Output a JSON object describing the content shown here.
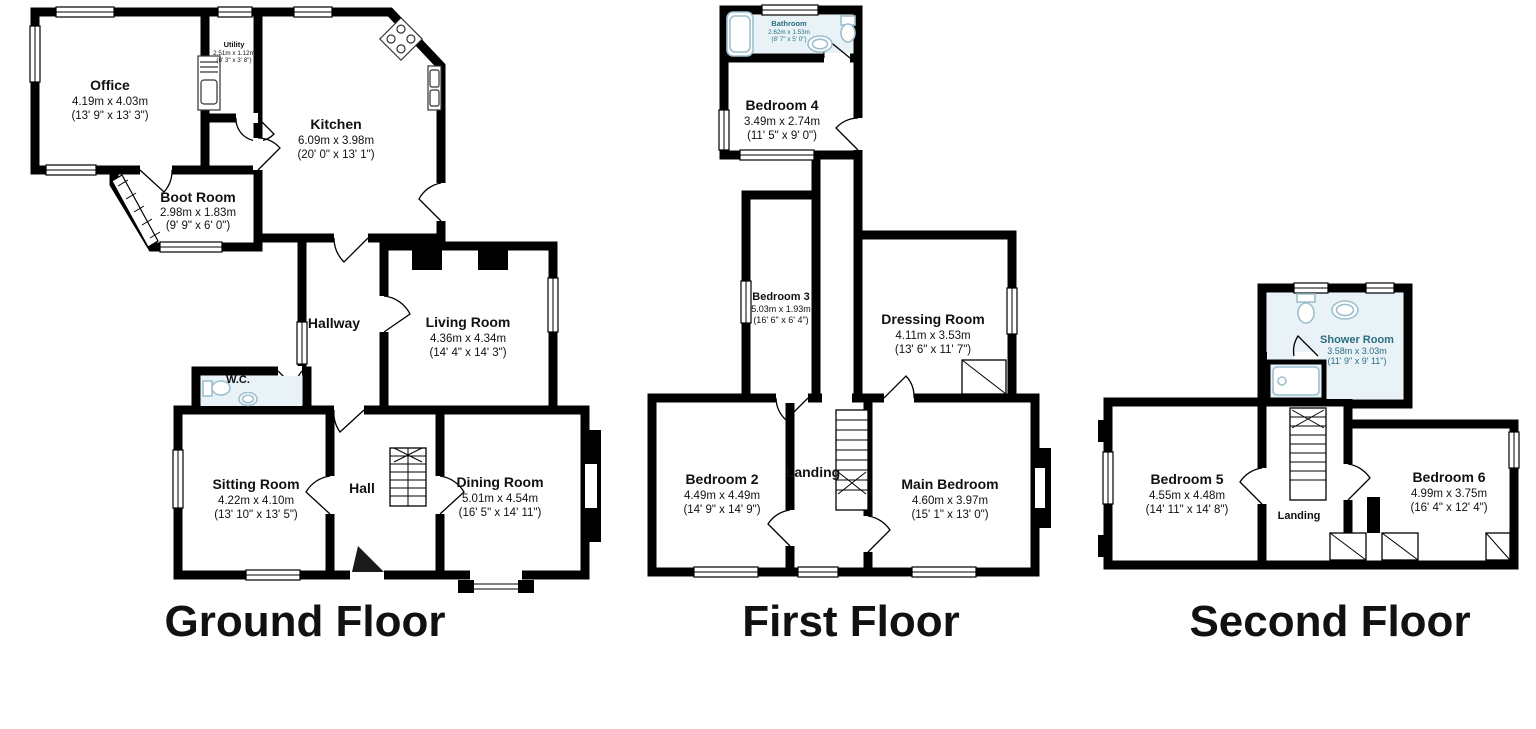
{
  "colors": {
    "wall": "#000000",
    "wet_room_fill": "#e8f2f7",
    "wet_room_label": "#2a6f80",
    "fixture": "#9cc0ce",
    "label": "#111111"
  },
  "floors": [
    {
      "title": "Ground Floor",
      "rooms": [
        {
          "name": "Office",
          "metric": "4.19m x 4.03m",
          "imperial": "(13' 9\" x 13' 3\")"
        },
        {
          "name": "Utility",
          "metric": "2.51m x 1.12m",
          "imperial": "(8' 3\" x 3' 8\")"
        },
        {
          "name": "Kitchen",
          "metric": "6.09m x 3.98m",
          "imperial": "(20' 0\" x 13' 1\")"
        },
        {
          "name": "Boot Room",
          "metric": "2.98m x 1.83m",
          "imperial": "(9' 9\" x 6' 0\")"
        },
        {
          "name": "Hallway"
        },
        {
          "name": "Living Room",
          "metric": "4.36m x 4.34m",
          "imperial": "(14' 4\" x 14' 3\")"
        },
        {
          "name": "W.C."
        },
        {
          "name": "Sitting Room",
          "metric": "4.22m x 4.10m",
          "imperial": "(13' 10\" x 13' 5\")"
        },
        {
          "name": "Hall"
        },
        {
          "name": "Dining Room",
          "metric": "5.01m x 4.54m",
          "imperial": "(16' 5\" x 14' 11\")"
        }
      ]
    },
    {
      "title": "First Floor",
      "rooms": [
        {
          "name": "Bathroom",
          "metric": "2.62m x 1.53m",
          "imperial": "(8' 7\" x 5' 0\")"
        },
        {
          "name": "Bedroom 4",
          "metric": "3.49m x 2.74m",
          "imperial": "(11' 5\" x 9' 0\")"
        },
        {
          "name": "Bedroom 3",
          "metric": "5.03m x 1.93m",
          "imperial": "(16' 6\" x 6' 4\")"
        },
        {
          "name": "Dressing Room",
          "metric": "4.11m x 3.53m",
          "imperial": "(13' 6\" x 11' 7\")"
        },
        {
          "name": "Bedroom 2",
          "metric": "4.49m x 4.49m",
          "imperial": "(14' 9\" x 14' 9\")"
        },
        {
          "name": "Landing"
        },
        {
          "name": "Main Bedroom",
          "metric": "4.60m x 3.97m",
          "imperial": "(15' 1\" x 13' 0\")"
        }
      ]
    },
    {
      "title": "Second Floor",
      "rooms": [
        {
          "name": "Shower Room",
          "metric": "3.58m x 3.03m",
          "imperial": "(11' 9\" x 9' 11\")"
        },
        {
          "name": "Bedroom 5",
          "metric": "4.55m x 4.48m",
          "imperial": "(14' 11\" x 14' 8\")"
        },
        {
          "name": "Landing"
        },
        {
          "name": "Bedroom 6",
          "metric": "4.99m x 3.75m",
          "imperial": "(16' 4\" x 12' 4\")"
        }
      ]
    }
  ]
}
